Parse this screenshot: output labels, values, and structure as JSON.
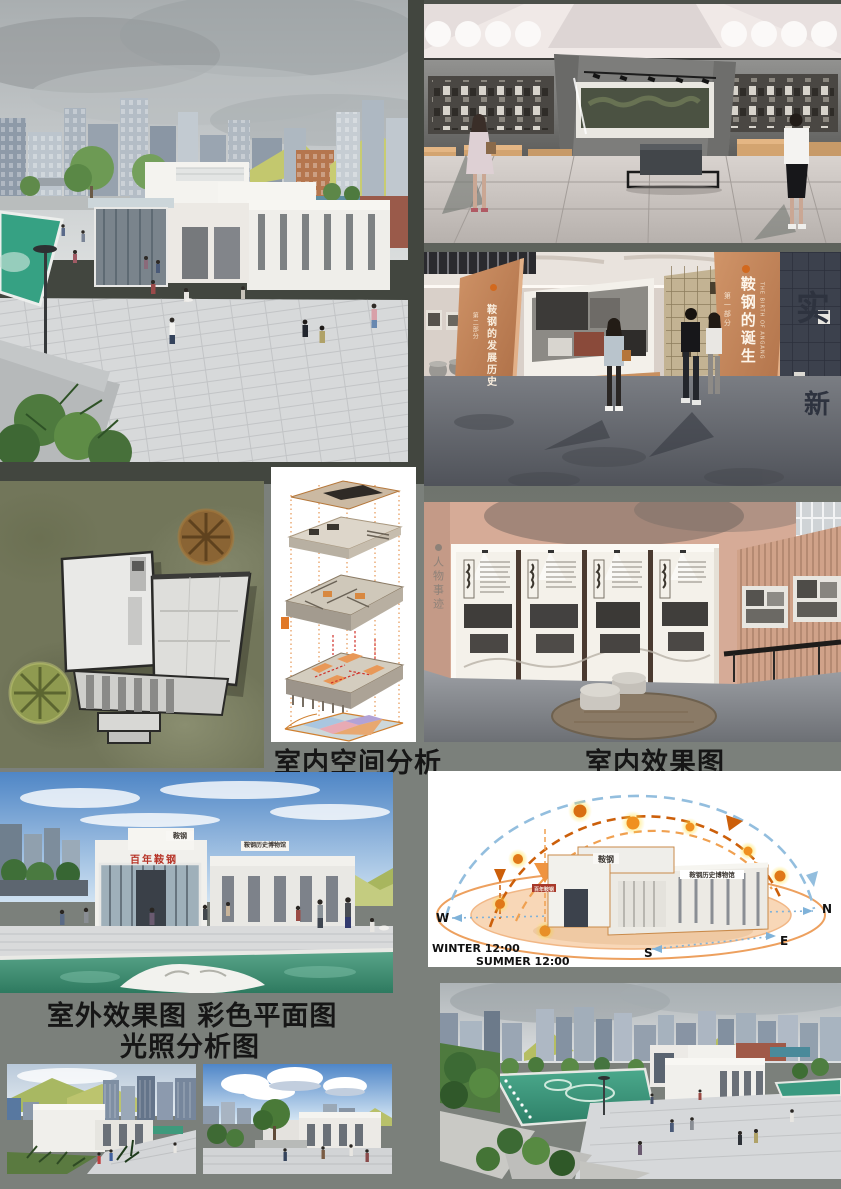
{
  "board": {
    "background": "#7b807b",
    "top_left_backdrop": "#42463f"
  },
  "captions": {
    "interior_space_analysis": "室内空间分析",
    "interior_render": "室内效果图",
    "exterior_and_plan": "室外效果图 彩色平面图",
    "light_analysis": "光照分析图"
  },
  "sun_diagram": {
    "compass": {
      "west": "W",
      "north": "N",
      "south": "S",
      "east": "E"
    },
    "winter_label": "WINTER 12:00",
    "summer_label": "SUMMER 12:00",
    "building_roof_sign": "鞍钢历史博物馆",
    "building_parapet_sign": "鞍钢",
    "building_front_sign": "百年鞍钢",
    "colors": {
      "summer_arc_blue": "#93bede",
      "winter_arc_orange": "#cc5f0a",
      "mid_arc_orange": "#f0a050",
      "ground_ring": "#eda05e",
      "ground_fill": "#f6caa0",
      "sun_core": "#e07818",
      "sun_glow": "#ffe14a"
    }
  },
  "interior_copper": {
    "right_panel": {
      "section": "第一部分",
      "title": "鞍钢的诞生",
      "subtitle_en": "THE BIRTH OF ANGANG"
    },
    "left_panel": {
      "section": "第二部分",
      "title": "鞍钢的发展历史"
    },
    "relief_wall_characters": [
      "实",
      "新"
    ],
    "copper_color": "#c08050"
  },
  "interior_photo_wall": {
    "side_label": "人物事迹"
  },
  "entrance_render": {
    "red_sign": "百年鞍钢",
    "parapet_sign": "鞍钢",
    "roof_sign": "鞍钢历史博物馆",
    "red_sign_color": "#b63226"
  }
}
